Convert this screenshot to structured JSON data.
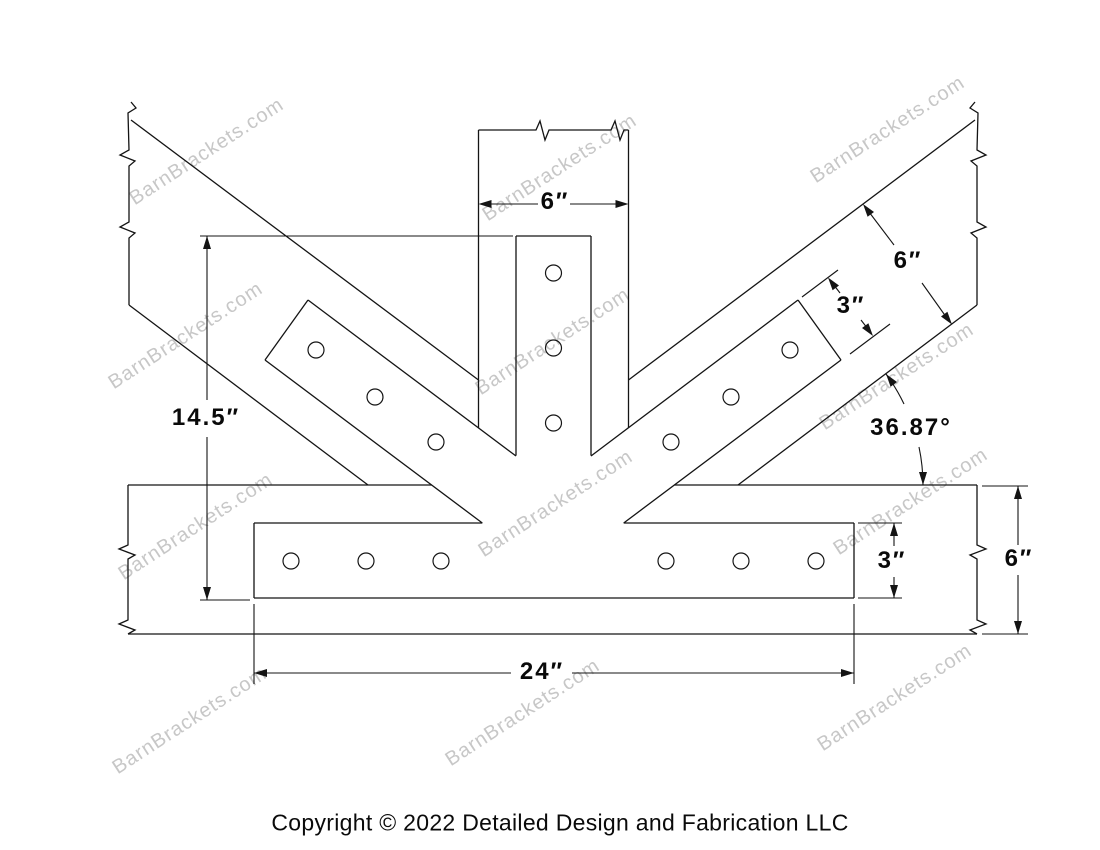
{
  "watermark": {
    "text": "BarnBrackets.com",
    "color": "#c7c7c7"
  },
  "drawing": {
    "dimensions": {
      "post_width": "6″",
      "web_width": "6″",
      "web_strap_width": "3″",
      "overall_height": "14.5″",
      "web_angle": "36.87°",
      "chord_strap_height": "3″",
      "chord_height": "6″",
      "chord_strap_length": "24″"
    },
    "copyright": "Copyright © 2022 Detailed Design and Fabrication LLC"
  }
}
